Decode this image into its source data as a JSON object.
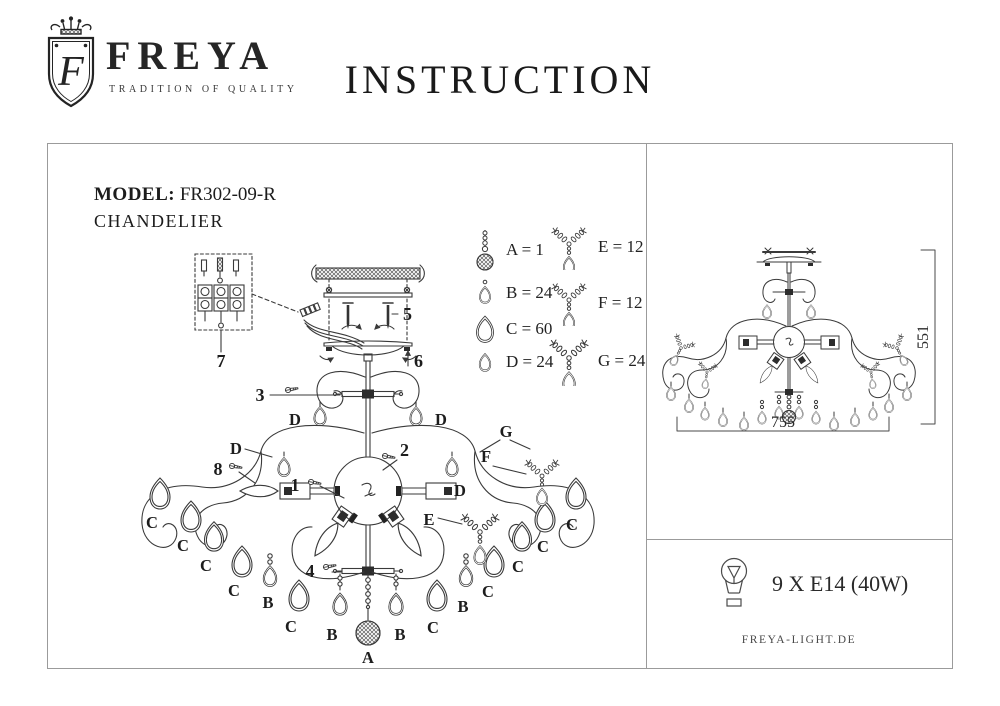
{
  "header": {
    "brand": "FREYA",
    "tagline": "TRADITION OF QUALITY",
    "monogram": "F",
    "title": "INSTRUCTION"
  },
  "product": {
    "model_label": "MODEL:",
    "model_number": "FR302-09-R",
    "type": "CHANDELIER"
  },
  "legend": {
    "col1": [
      {
        "id": "A",
        "label": "A = 1",
        "icon": "bead-chain-faceted-ball"
      },
      {
        "id": "B",
        "label": "B = 24",
        "icon": "small-drop-with-bead"
      },
      {
        "id": "C",
        "label": "C = 60",
        "icon": "large-teardrop"
      },
      {
        "id": "D",
        "label": "D = 24",
        "icon": "small-teardrop"
      }
    ],
    "col2": [
      {
        "id": "E",
        "label": "E = 12",
        "icon": "bead-branch-with-drop"
      },
      {
        "id": "F",
        "label": "F = 12",
        "icon": "bead-branch-with-drop"
      },
      {
        "id": "G",
        "label": "G = 24",
        "icon": "bead-branch-with-drop"
      }
    ]
  },
  "callouts": {
    "n1": "1",
    "n2": "2",
    "n3": "3",
    "n4": "4",
    "n5": "5",
    "n6": "6",
    "n7": "7",
    "n8": "8"
  },
  "letters": {
    "A": "A",
    "B": "B",
    "C": "C",
    "D": "D",
    "E": "E",
    "F": "F",
    "G": "G"
  },
  "dimensions": {
    "width": "755",
    "height": "551"
  },
  "bulb": {
    "spec": "9 X E14 (40W)"
  },
  "footer": {
    "website": "FREYA-LIGHT.DE"
  },
  "colors": {
    "ink": "#1c1c1c",
    "line": "#3a3a3a",
    "border": "#9b9b9b"
  }
}
